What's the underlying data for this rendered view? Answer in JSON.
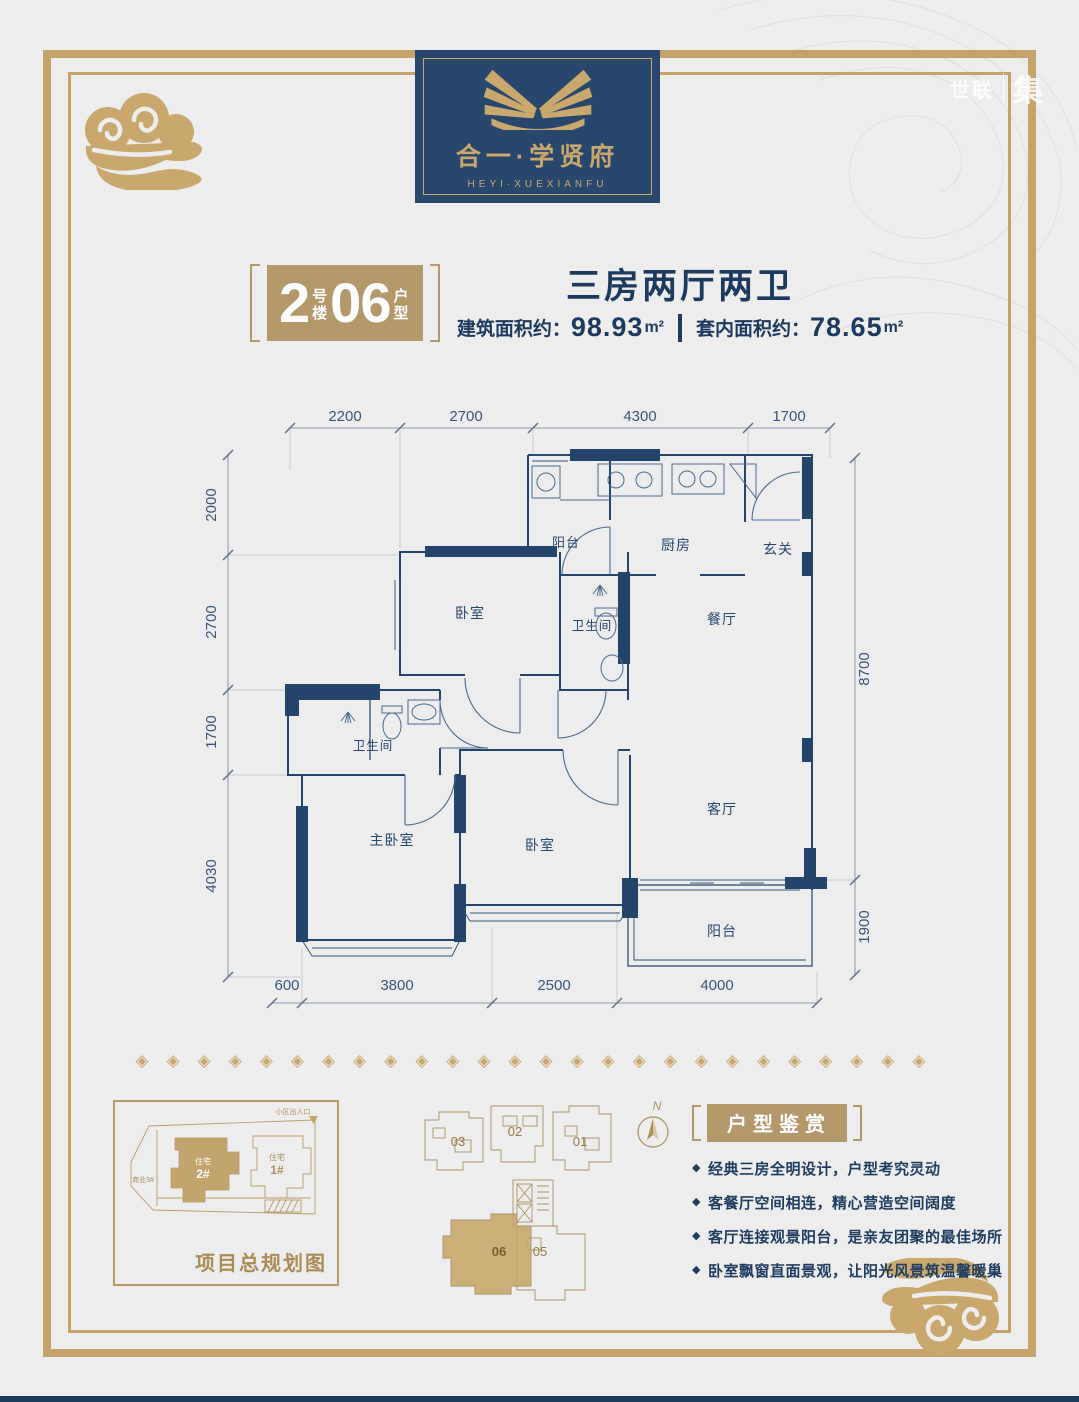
{
  "watermark": {
    "name1": "世联",
    "name2": "集"
  },
  "logo": {
    "title": "合一·学贤府",
    "subtitle": "HEYI·XUEXIANFU"
  },
  "unit_badge": {
    "num1": "2",
    "cap1a": "号",
    "cap1b": "楼",
    "num2": "06",
    "cap2a": "户",
    "cap2b": "型"
  },
  "header": {
    "title": "三房两厅两卫",
    "area1_label": "建筑面积约：",
    "area1_value": "98.93",
    "area1_unit": "m²",
    "area2_label": "套内面积约：",
    "area2_value": "78.65",
    "area2_unit": "m²"
  },
  "floorplan": {
    "dims_top": [
      "2200",
      "2700",
      "4300",
      "1700"
    ],
    "dims_left": [
      "2000",
      "2700",
      "1700",
      "4030"
    ],
    "dims_right": [
      "8700",
      "1900"
    ],
    "dims_bottom": [
      "600",
      "3800",
      "2500",
      "4000"
    ],
    "rooms": [
      "阳台",
      "厨房",
      "玄关",
      "卧室",
      "卫生间",
      "餐厅",
      "卫生间",
      "主卧室",
      "卧室",
      "客厅",
      "阳台"
    ]
  },
  "divider": {
    "ornaments": "◈◈◈◈◈◈◈◈◈◈◈◈◈◈◈◈◈◈◈◈◈◈◈◈◈◈"
  },
  "siteplan": {
    "title": "项目总规划图",
    "b2_line1": "住宅",
    "b2_line2": "2#",
    "b1_line1": "住宅",
    "b1_line2": "1#",
    "biz": "商业3#",
    "entry": "小区出入口"
  },
  "keyplan": {
    "unit_03": "03",
    "unit_02": "02",
    "unit_01": "01",
    "unit_06": "06",
    "unit_05": "05",
    "compass": "N"
  },
  "appreciation": {
    "title": "户型鉴赏",
    "points": [
      "经典三房全明设计，户型考究灵动",
      "客餐厅空间相连，精心营造空间阔度",
      "客厅连接观景阳台，是亲友团聚的最佳场所",
      "卧室飘窗直面景观，让阳光风景筑温馨暖巢"
    ]
  }
}
